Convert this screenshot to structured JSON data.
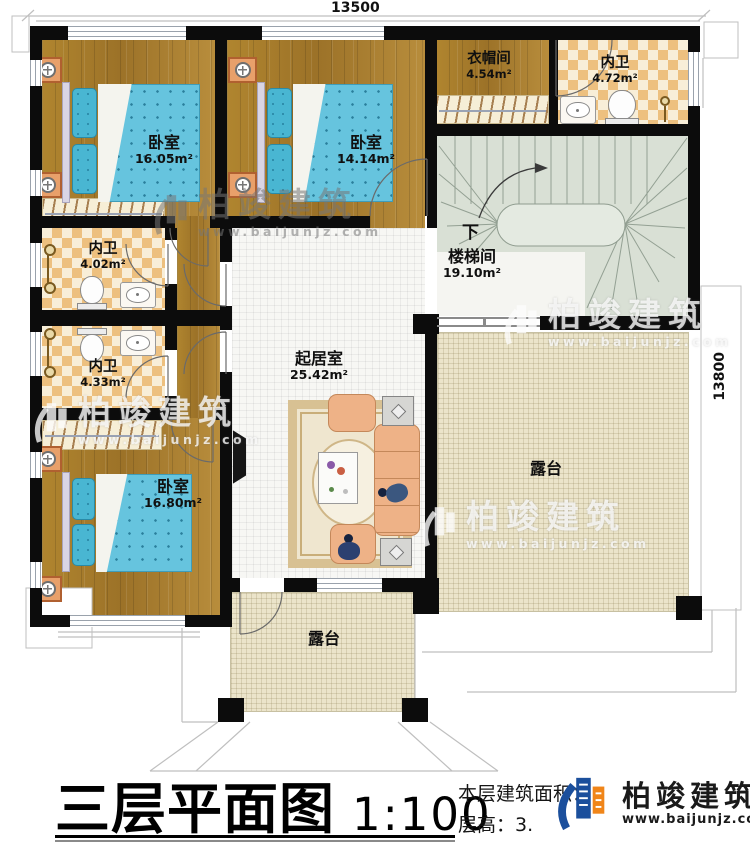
{
  "dimensions": {
    "top": "13500",
    "right": "13800"
  },
  "rooms": {
    "bedroom_top_left": {
      "name": "卧室",
      "area": "16.05m²"
    },
    "bedroom_top_middle": {
      "name": "卧室",
      "area": "14.14m²"
    },
    "cloakroom": {
      "name": "衣帽间",
      "area": "4.54m²"
    },
    "bathroom_top_right": {
      "name": "内卫",
      "area": "4.72m²"
    },
    "stairwell": {
      "name": "楼梯间",
      "area": "19.10m²",
      "direction_label": "下"
    },
    "bathroom_mid_upper": {
      "name": "内卫",
      "area": "4.02m²"
    },
    "bathroom_mid_lower": {
      "name": "内卫",
      "area": "4.33m²"
    },
    "living_room": {
      "name": "起居室",
      "area": "25.42m²"
    },
    "bedroom_bottom": {
      "name": "卧室",
      "area": "16.80m²"
    },
    "terrace_right": {
      "name": "露台"
    },
    "terrace_bottom": {
      "name": "露台"
    }
  },
  "watermark": {
    "brand": "柏竣建筑",
    "url": "www.baijunjz.com"
  },
  "title_block": {
    "title": "三层平面图",
    "scale": "1:100",
    "info_line1": "本层建筑面积：",
    "info_line2": "层高：3.",
    "brand": "柏竣建筑",
    "brand_url": "www.baijunjz.com"
  },
  "colors": {
    "wall": "#0c0c0c",
    "wood_floor": "#a97e31",
    "tile_checker": "#edc07f",
    "stair_floor": "#d9e0d5",
    "terrace_floor": "#ebe4ca",
    "mattress_blue": "#66c4de",
    "sofa_peach": "#eeb287",
    "brand_blue": "#1b4f9c",
    "brand_orange": "#f08519"
  }
}
